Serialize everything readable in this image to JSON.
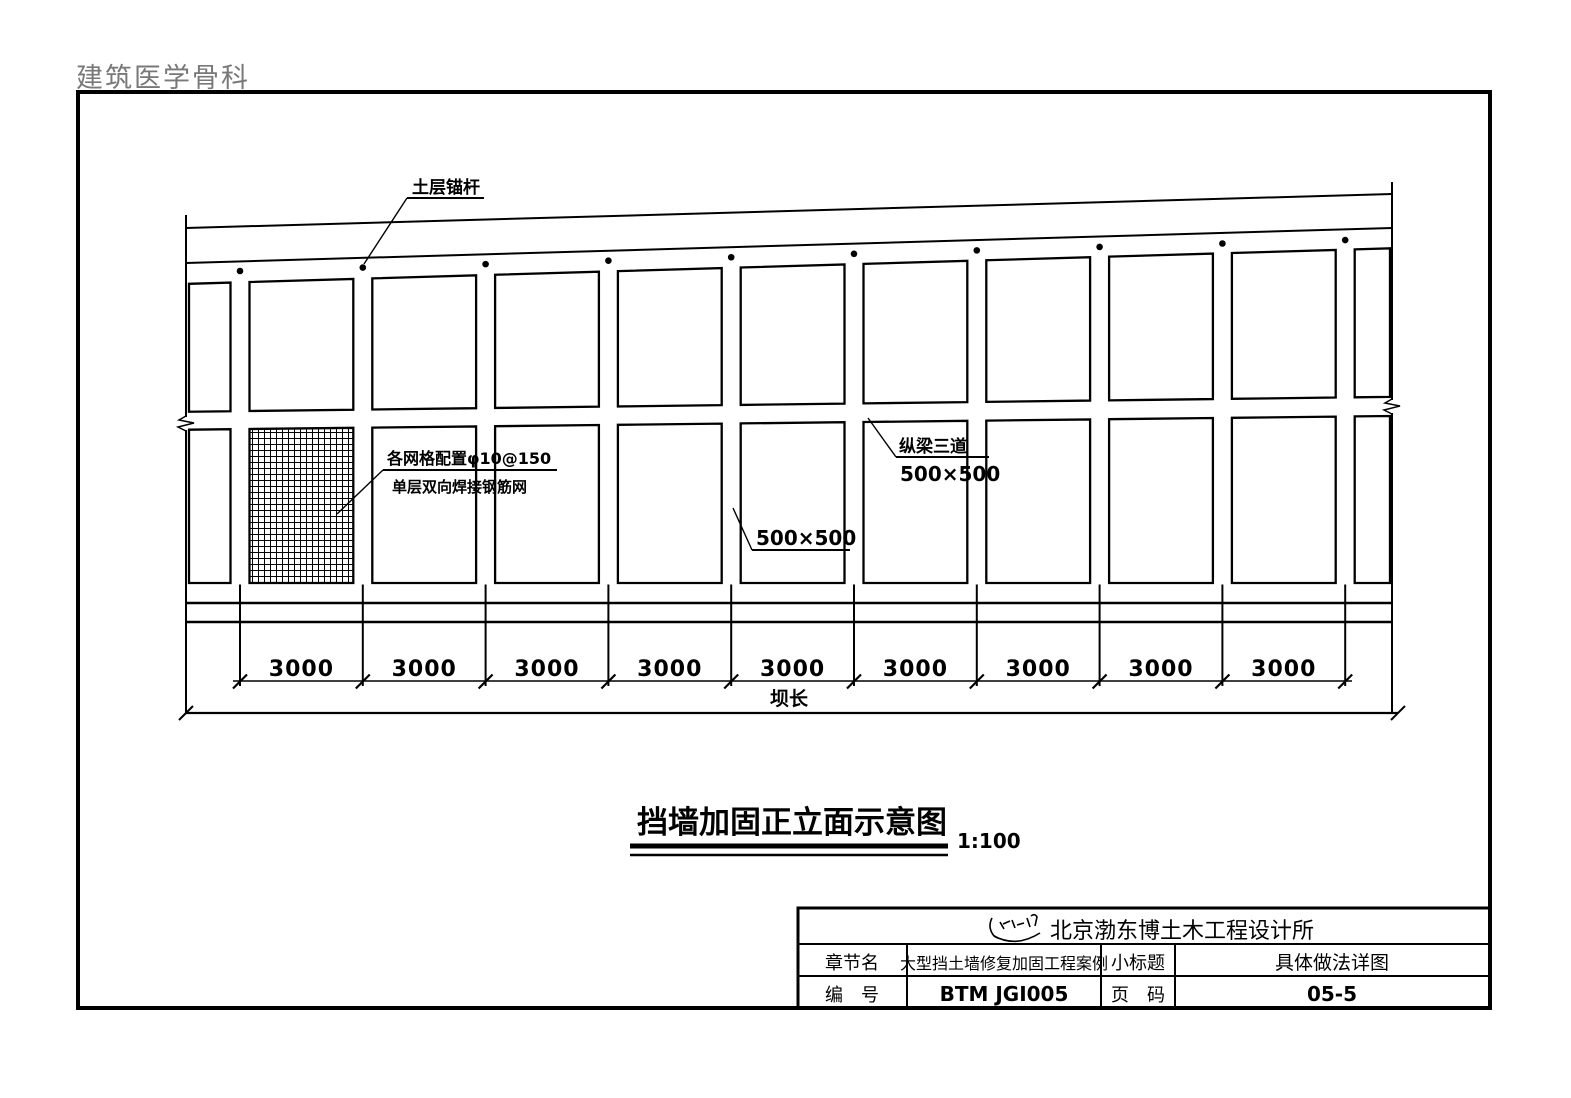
{
  "page": {
    "watermark": "建筑医学骨科"
  },
  "drawing": {
    "labels": {
      "anchor": "土层锚杆",
      "mesh_line1": "各网格配置φ10@150",
      "mesh_line2": "单层双向焊接钢筋网",
      "beam_line1": "纵梁三道",
      "beam_line2": "500×500",
      "panel_size": "500×500"
    },
    "dimensions": {
      "segments": [
        "3000",
        "3000",
        "3000",
        "3000",
        "3000",
        "3000",
        "3000",
        "3000",
        "3000"
      ],
      "total_label": "坝长"
    },
    "title": {
      "text": "挡墙加固正立面示意图",
      "scale": "1:100"
    }
  },
  "title_block": {
    "company": "北京渤东博土木工程设计所",
    "row2": {
      "label1": "章节名",
      "value1": "大型挡土墙修复加固工程案例",
      "label2": "小标题",
      "value2": "具体做法详图"
    },
    "row3": {
      "label1": "编　号",
      "value1": "BTM JGI005",
      "label2": "页　码",
      "value2": "05-5"
    }
  },
  "colors": {
    "ink": "#000000",
    "watermark_gray": "#787878",
    "paper": "#ffffff"
  }
}
